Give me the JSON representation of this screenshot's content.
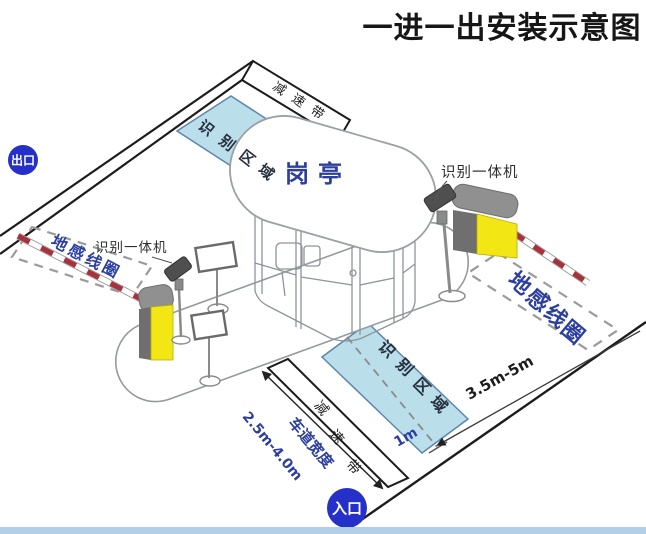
{
  "title": "一进一出安装示意图",
  "badges": {
    "exit": "出口",
    "entrance": "入口"
  },
  "booth": {
    "label": "岗亭"
  },
  "areas": {
    "recognition_top": "识别区域",
    "recognition_bottom": "识别区域"
  },
  "coils": {
    "left_label": "地感线圈",
    "right_label": "地感线圈"
  },
  "speed_bumps": {
    "top": "减速带",
    "bottom": "减速带"
  },
  "devices": {
    "reader_left": "识别一体机",
    "reader_right": "识别一体机"
  },
  "measurements": {
    "coil_distance": "3.5m-5m",
    "stop_line_offset": "1m",
    "lane_width_label": "车道宽度",
    "lane_width_value": "2.5m-4.0m"
  },
  "colors": {
    "badge_blue": "#2430c8",
    "label_blue": "#2c3f9e",
    "area_fill": "#b7dcea",
    "area_border": "#5e86ad",
    "barrier_yellow": "#f2e614",
    "arm_red": "#a8323c",
    "bottom_strip": "#b3cfe8"
  }
}
